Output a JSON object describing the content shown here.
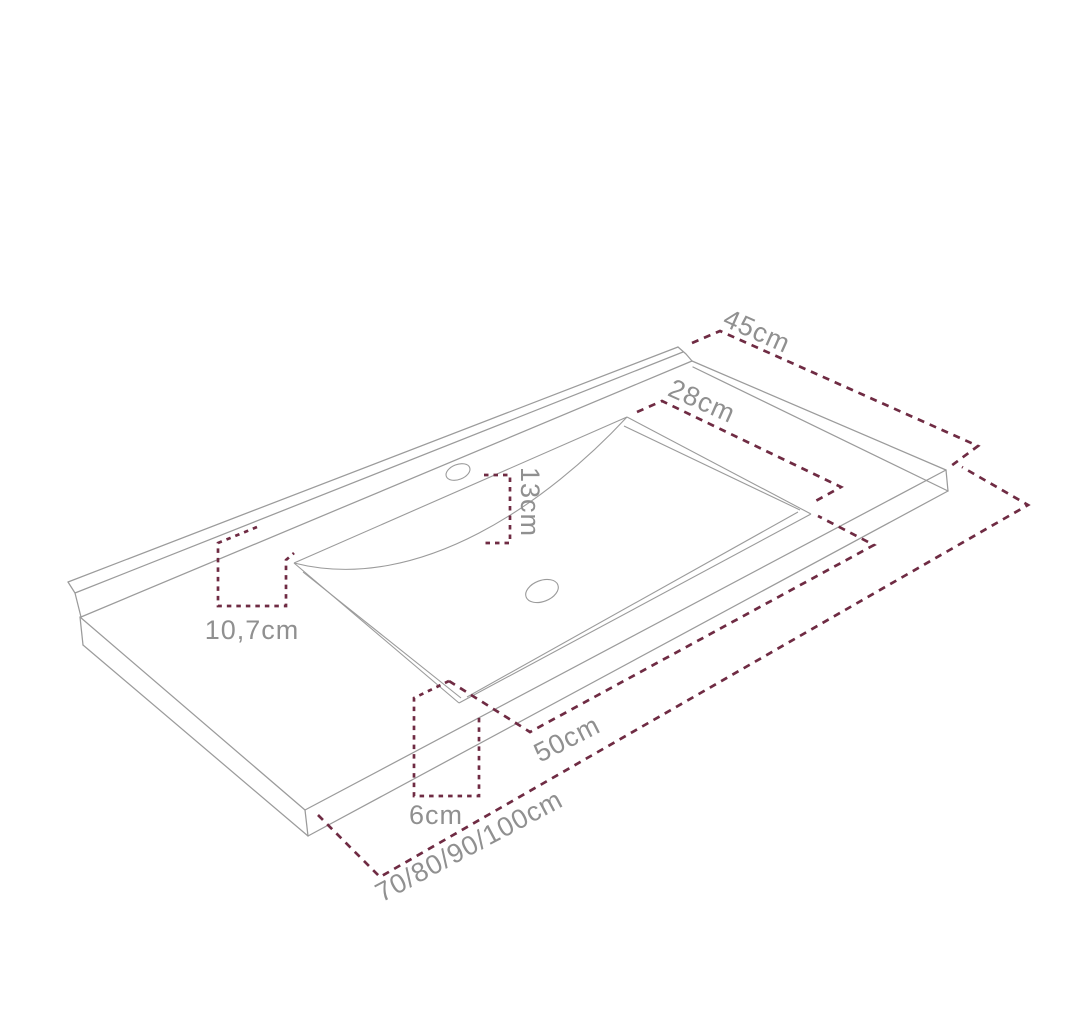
{
  "diagram": {
    "subject": "washbasin-countertop-technical-drawing",
    "colors": {
      "background": "#ffffff",
      "outline": "#9b9b9b",
      "dimension_lines": "#6f2b43",
      "labels": "#909090"
    },
    "dimensions": [
      {
        "id": "countertop-depth",
        "label": "45cm"
      },
      {
        "id": "basin-depth",
        "label": "28cm"
      },
      {
        "id": "basin-back-offset",
        "label": "13cm"
      },
      {
        "id": "left-offset",
        "label": "10,7cm"
      },
      {
        "id": "basin-width",
        "label": "50cm"
      },
      {
        "id": "front-edge-height",
        "label": "6cm"
      },
      {
        "id": "overall-width-options",
        "label": "70/80/90/100cm"
      }
    ]
  }
}
